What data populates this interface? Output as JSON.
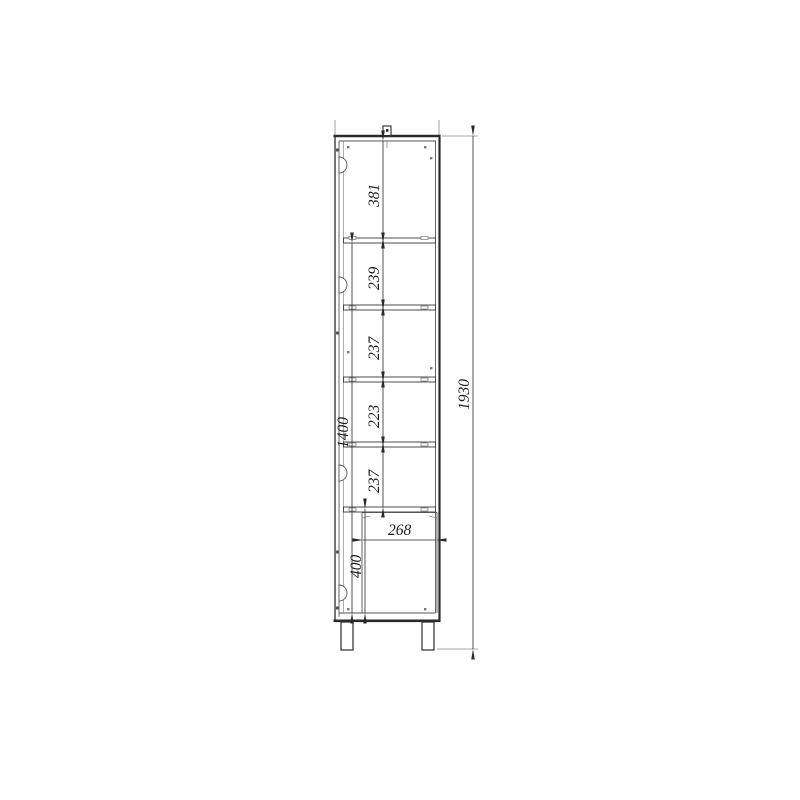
{
  "drawing": {
    "kind": "cabinet-section-technical-drawing",
    "line_color": "#2a2a2a",
    "thin_line_color": "#6b6b6b",
    "background": "#ffffff"
  },
  "dimensions": {
    "overall_height": "1930",
    "opening_height": "1400",
    "top_section_height": "381",
    "shelf_sections": [
      "239",
      "237",
      "223",
      "237"
    ],
    "bottom_section_height": "400",
    "inner_depth": "268"
  }
}
